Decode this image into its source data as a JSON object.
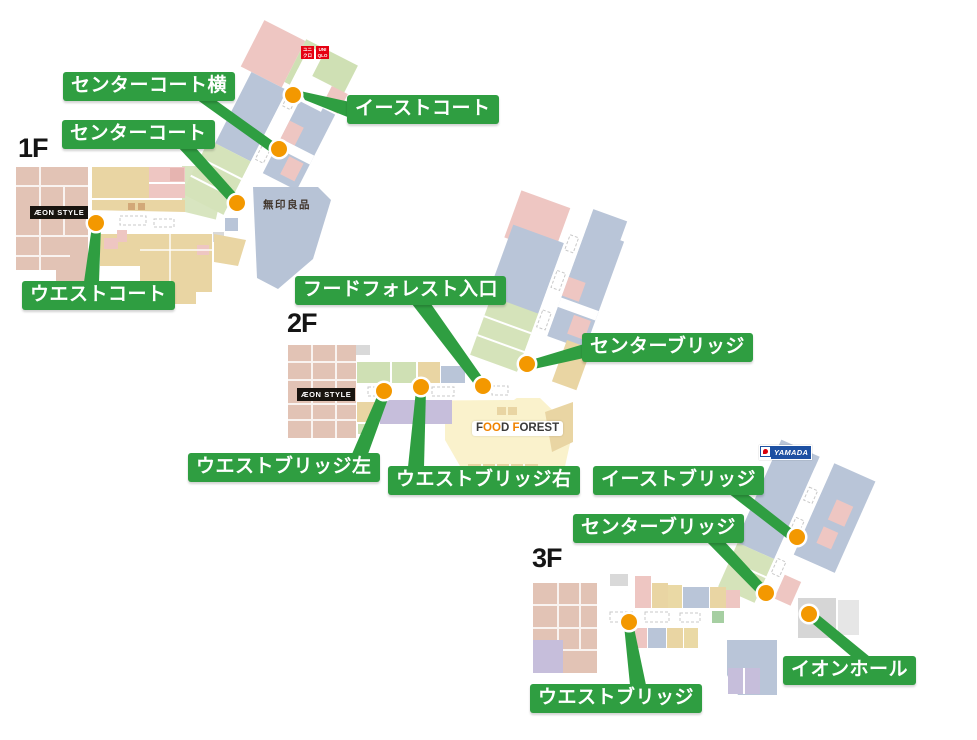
{
  "floors": [
    {
      "name": "1F",
      "labels": {
        "center_court_side": "センターコート横",
        "east_court": "イーストコート",
        "center_court": "センターコート",
        "west_court": "ウエストコート"
      },
      "logos": {
        "aeon_style": "ÆON STYLE",
        "muji": "無印良品",
        "uniqlo_kana1": "ユニ",
        "uniqlo_kana2": "クロ",
        "uniqlo_en1": "UNI",
        "uniqlo_en2": "QLO"
      }
    },
    {
      "name": "2F",
      "labels": {
        "food_forest_entrance": "フードフォレスト入口",
        "center_bridge": "センターブリッジ",
        "west_bridge_left": "ウエストブリッジ左",
        "west_bridge_right": "ウエストブリッジ右"
      },
      "logos": {
        "aeon_style": "ÆON STYLE",
        "ff_f1": "F",
        "ff_o1": "O",
        "ff_o2": "O",
        "ff_d": "D",
        "ff_sp": " ",
        "ff_f2": "F",
        "ff_rest": "OREST"
      }
    },
    {
      "name": "3F",
      "labels": {
        "east_bridge": "イーストブリッジ",
        "center_bridge": "センターブリッジ",
        "aeon_hall": "イオンホール",
        "west_bridge": "ウエストブリッジ"
      },
      "logos": {
        "yamada": "YAMADA"
      }
    }
  ],
  "colors": {
    "label_green": "#2f9e41",
    "dot_orange": "#f39800",
    "aeon_salmon": "#e2c3b5",
    "shop_tan": "#e9d5a3",
    "shop_pink": "#eec6c2",
    "shop_blue": "#b9c5d8",
    "shop_green": "#cfe0b4",
    "shop_purple": "#c6bedb",
    "food_court_cream": "#faf2cc",
    "uniqlo_red": "#e60012",
    "yamada_blue": "#1d50a2"
  }
}
